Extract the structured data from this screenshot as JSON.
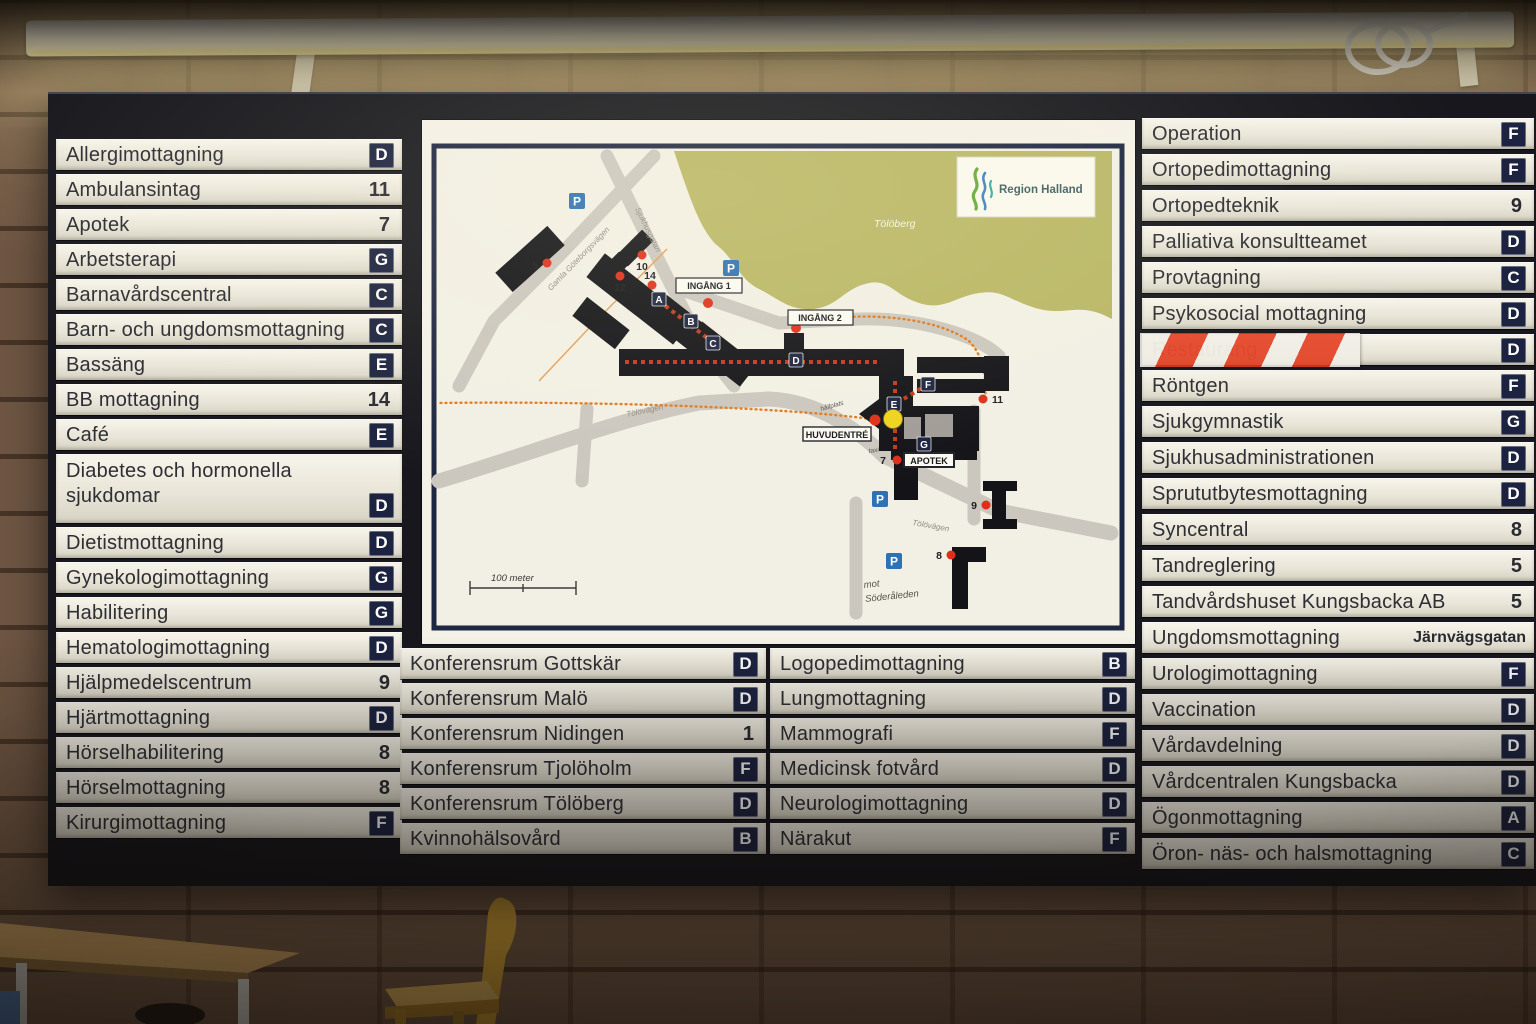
{
  "directory": {
    "left": [
      {
        "label": "Allergimottagning",
        "value": "D",
        "type": "badge"
      },
      {
        "label": "Ambulansintag",
        "value": "11",
        "type": "number"
      },
      {
        "label": "Apotek",
        "value": "7",
        "type": "number"
      },
      {
        "label": "Arbetsterapi",
        "value": "G",
        "type": "badge"
      },
      {
        "label": "Barnavårdscentral",
        "value": "C",
        "type": "badge"
      },
      {
        "label": "Barn- och ungdomsmottagning",
        "value": "C",
        "type": "badge"
      },
      {
        "label": "Bassäng",
        "value": "E",
        "type": "badge"
      },
      {
        "label": "BB mottagning",
        "value": "14",
        "type": "number"
      },
      {
        "label": "Café",
        "value": "E",
        "type": "badge"
      },
      {
        "label": "Diabetes och hormonella sjukdomar",
        "value": "D",
        "type": "badge"
      },
      {
        "label": "Dietistmottagning",
        "value": "D",
        "type": "badge"
      },
      {
        "label": "Gynekologimottagning",
        "value": "G",
        "type": "badge"
      },
      {
        "label": "Habilitering",
        "value": "G",
        "type": "badge"
      },
      {
        "label": "Hematologimottagning",
        "value": "D",
        "type": "badge"
      },
      {
        "label": "Hjälpmedelscentrum",
        "value": "9",
        "type": "number"
      },
      {
        "label": "Hjärtmottagning",
        "value": "D",
        "type": "badge"
      },
      {
        "label": "Hörselhabilitering",
        "value": "8",
        "type": "number"
      },
      {
        "label": "Hörselmottagning",
        "value": "8",
        "type": "number"
      },
      {
        "label": "Kirurgimottagning",
        "value": "F",
        "type": "badge"
      }
    ],
    "mid1": [
      {
        "label": "Konferensrum Gottskär",
        "value": "D",
        "type": "badge"
      },
      {
        "label": "Konferensrum Malö",
        "value": "D",
        "type": "badge"
      },
      {
        "label": "Konferensrum Nidingen",
        "value": "1",
        "type": "number"
      },
      {
        "label": "Konferensrum Tjolöholm",
        "value": "F",
        "type": "badge"
      },
      {
        "label": "Konferensrum Tölöberg",
        "value": "D",
        "type": "badge"
      },
      {
        "label": "Kvinnohälsovård",
        "value": "B",
        "type": "badge"
      }
    ],
    "mid2": [
      {
        "label": "Logopedimottagning",
        "value": "B",
        "type": "badge"
      },
      {
        "label": "Lungmottagning",
        "value": "D",
        "type": "badge"
      },
      {
        "label": "Mammografi",
        "value": "F",
        "type": "badge"
      },
      {
        "label": "Medicinsk fotvård",
        "value": "D",
        "type": "badge"
      },
      {
        "label": "Neurologimottagning",
        "value": "D",
        "type": "badge"
      },
      {
        "label": "Närakut",
        "value": "F",
        "type": "badge"
      }
    ],
    "right": [
      {
        "label": "Operation",
        "value": "F",
        "type": "badge"
      },
      {
        "label": "Ortopedimottagning",
        "value": "F",
        "type": "badge"
      },
      {
        "label": "Ortopedteknik",
        "value": "9",
        "type": "number"
      },
      {
        "label": "Palliativa konsultteamet",
        "value": "D",
        "type": "badge"
      },
      {
        "label": "Provtagning",
        "value": "C",
        "type": "badge"
      },
      {
        "label": "Psykosocial mottagning",
        "value": "D",
        "type": "badge"
      },
      {
        "label": "Restaurang",
        "value": "D",
        "type": "badge",
        "taped": true
      },
      {
        "label": "Röntgen",
        "value": "F",
        "type": "badge"
      },
      {
        "label": "Sjukgymnastik",
        "value": "G",
        "type": "badge"
      },
      {
        "label": "Sjukhusadministrationen",
        "value": "D",
        "type": "badge"
      },
      {
        "label": "Sprututbytesmottagning",
        "value": "D",
        "type": "badge"
      },
      {
        "label": "Syncentral",
        "value": "8",
        "type": "number"
      },
      {
        "label": "Tandreglering",
        "value": "5",
        "type": "number"
      },
      {
        "label": "Tandvårdshuset Kungsbacka AB",
        "value": "5",
        "type": "number"
      },
      {
        "label": "Ungdomsmottagning",
        "value": "Järnvägsgatan",
        "type": "text"
      },
      {
        "label": "Urologimottagning",
        "value": "F",
        "type": "badge"
      },
      {
        "label": "Vaccination",
        "value": "D",
        "type": "badge"
      },
      {
        "label": "Vårdavdelning",
        "value": "D",
        "type": "badge"
      },
      {
        "label": "Vårdcentralen Kungsbacka",
        "value": "D",
        "type": "badge"
      },
      {
        "label": "Ögonmottagning",
        "value": "A",
        "type": "badge"
      },
      {
        "label": "Öron- näs- och halsmottagning",
        "value": "C",
        "type": "badge"
      }
    ]
  },
  "map": {
    "logo_text": "Region Halland",
    "area_label": "Tölöberg",
    "parking": "P",
    "badges": {
      "a": "A",
      "b": "B",
      "c": "C",
      "d": "D",
      "e": "E",
      "f": "F",
      "g": "G"
    },
    "labels": {
      "ingang1": "INGÅNG 1",
      "ingang2": "INGÅNG 2",
      "huvudentre": "HUVUDENTRÉ",
      "apotek": "APOTEK",
      "scale": "100 meter",
      "mot": "mot",
      "soderleden": "Söderåleden",
      "hallplats": "hållplats",
      "taxi": "taxi"
    },
    "streets": {
      "gamla": "Gamla Göteborgsvägen",
      "sjukhusgatan": "Sjukhusgatan",
      "tolovagen": "Tölövägen",
      "tolovagen2": "Tölövägen"
    },
    "numbers": {
      "n5": "5",
      "n7": "7",
      "n8": "8",
      "n9": "9",
      "n10": "10",
      "n11": "11",
      "n12": "12",
      "n14": "14"
    },
    "colors": {
      "badge_navy": "#1c2340",
      "parking_blue": "#2d72b5",
      "dot_red": "#df2f1a",
      "route_orange": "#e07a1e",
      "map_green": "#b9b765",
      "tape_red": "#e43a1c"
    }
  }
}
